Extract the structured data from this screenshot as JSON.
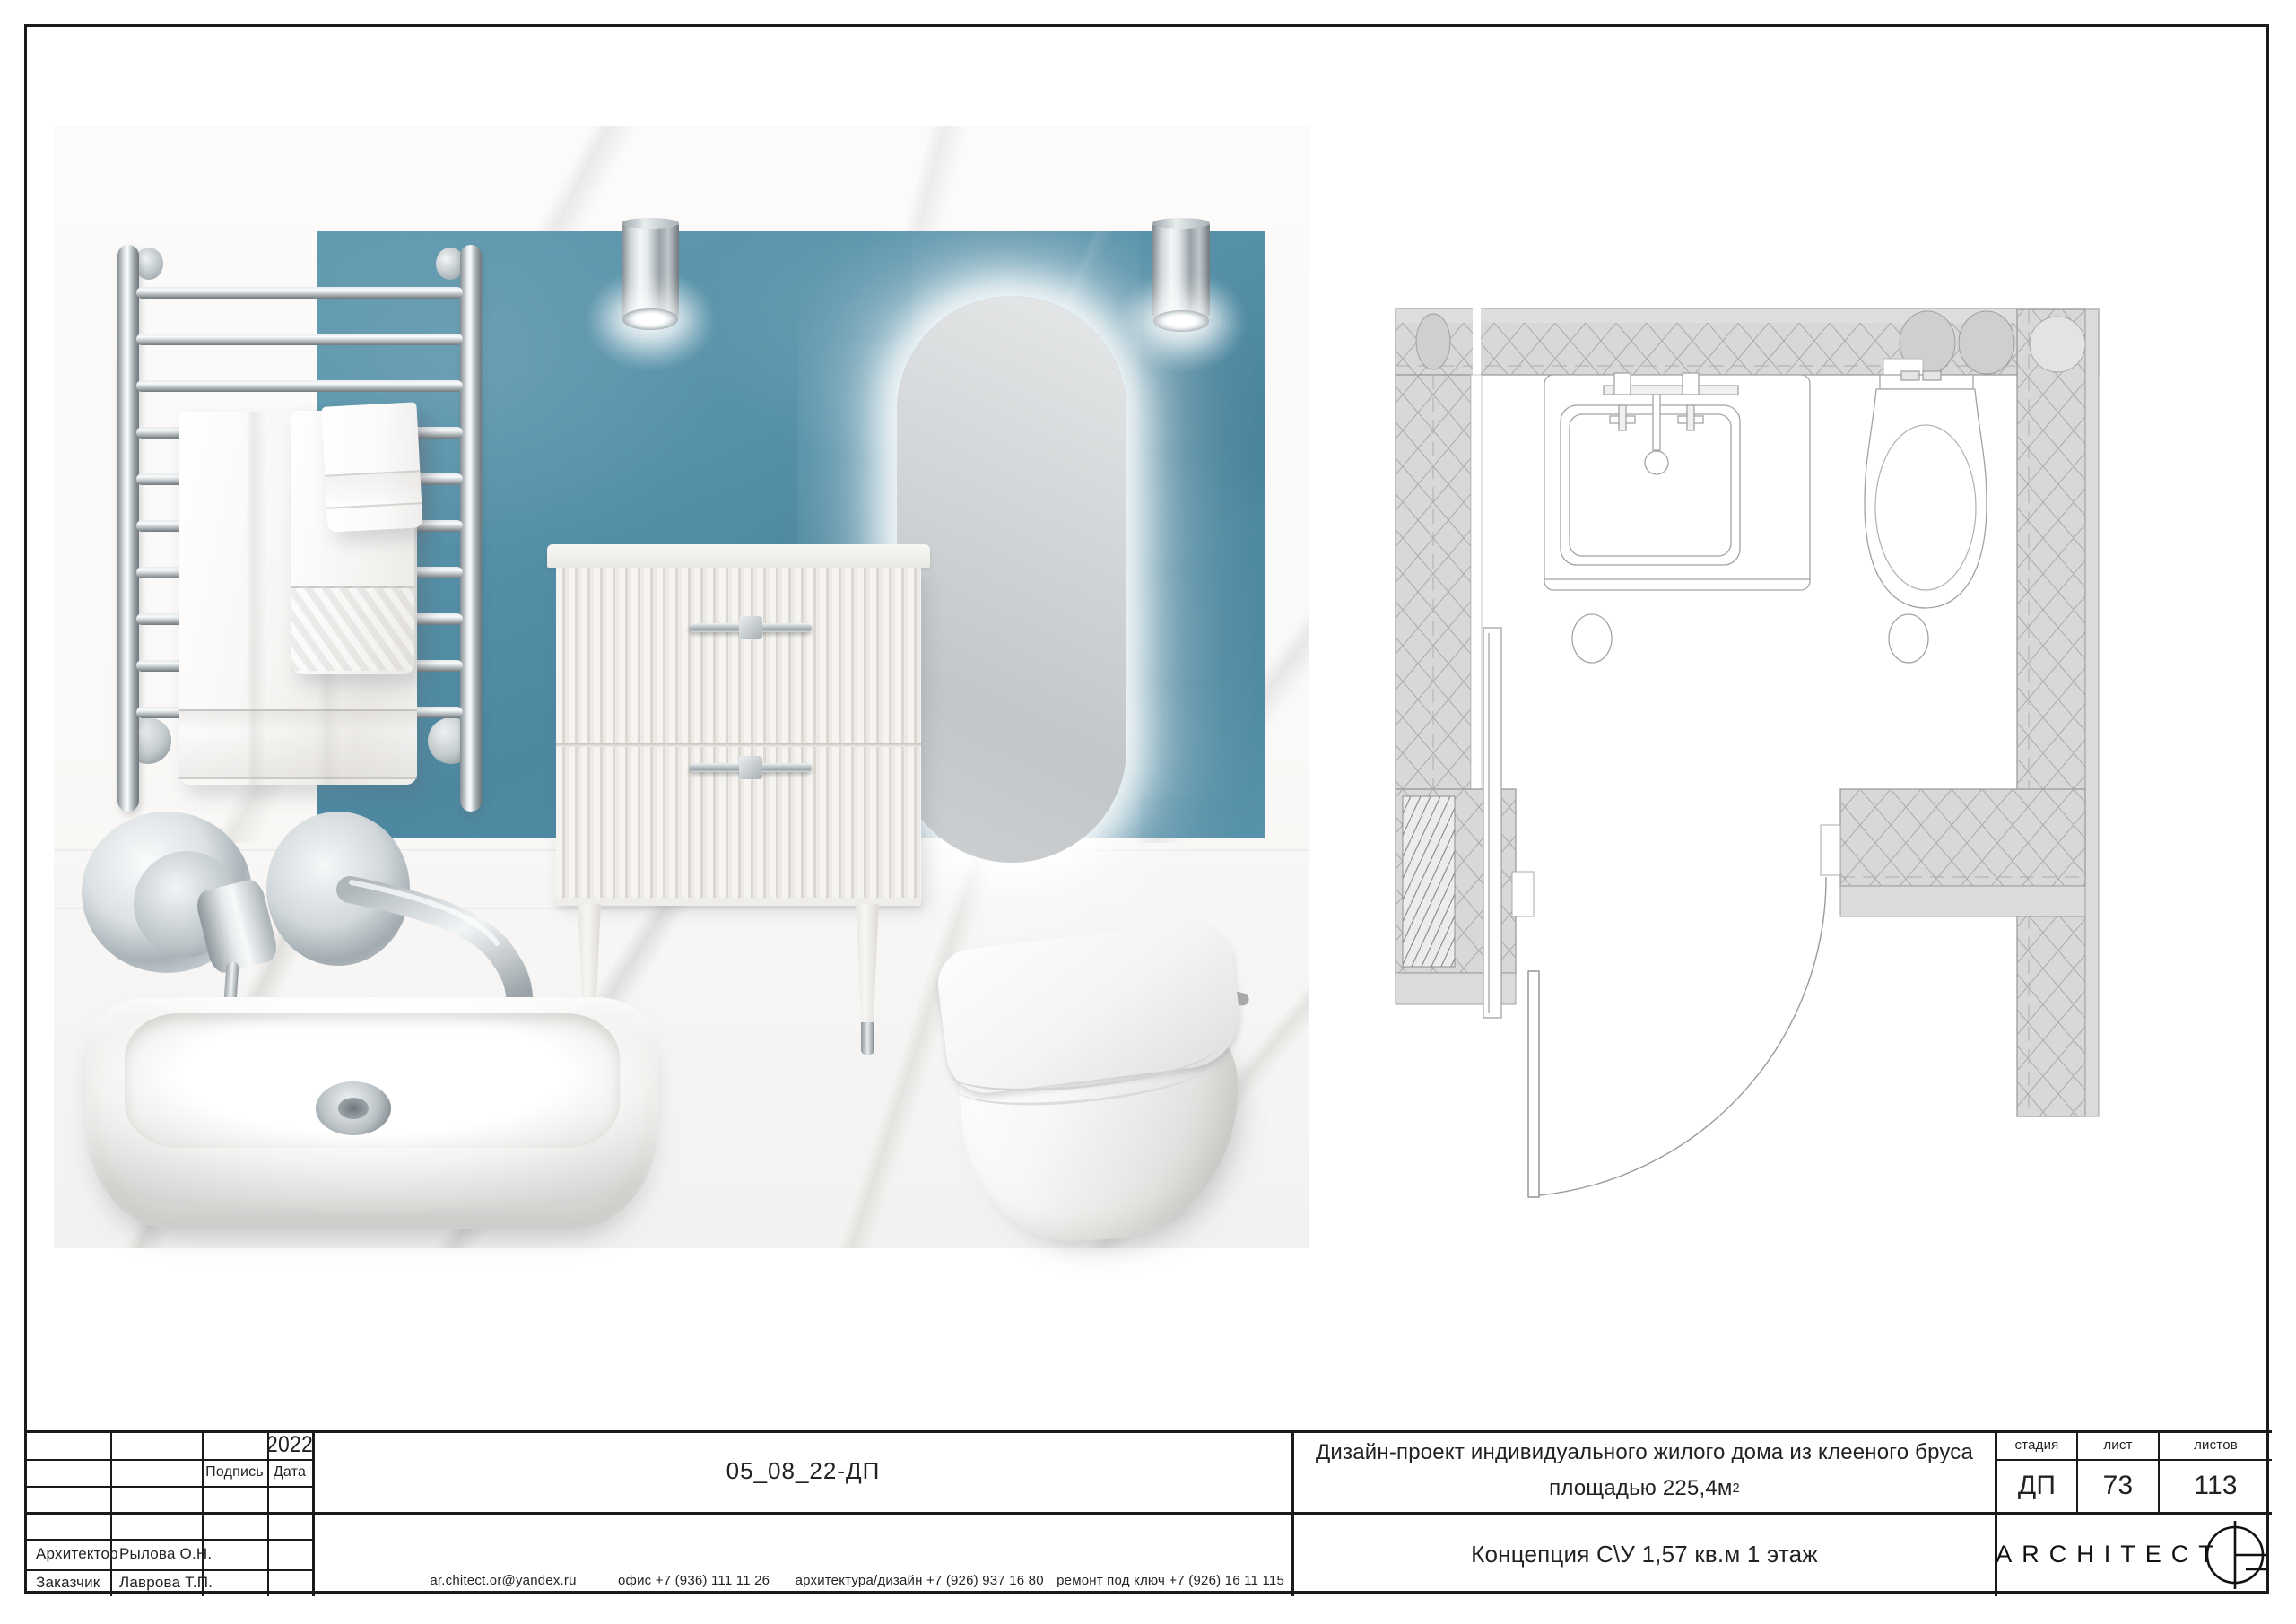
{
  "titleblock": {
    "year": "2022",
    "sign_label": "Подпись",
    "date_label": "Дата",
    "architect_label": "Архитектор",
    "architect_name": "Рылова О.Н.",
    "client_label": "Заказчик",
    "client_name": "Лаврова Т.П.",
    "doc_code": "05_08_22-ДП",
    "contact_email": "ar.chitect.or@yandex.ru",
    "contact_office": "офис +7 (936) 111 11 26",
    "contact_design": "архитектура/дизайн +7 (926) 937 16 80",
    "contact_turnkey": "ремонт под ключ +7 (926) 16 11 115",
    "project_title_line1": "Дизайн-проект индивидуального жилого дома из клееного бруса",
    "project_title_line2": "площадью 225,4м",
    "area_superscript": "2",
    "stage_label": "стадия",
    "sheet_label": "лист",
    "sheets_label": "листов",
    "stage_value": "ДП",
    "sheet_value": "73",
    "sheets_value": "113",
    "concept_caption": "Концепция С\\У 1,57 кв.м 1 этаж",
    "logo_text": "ARCHITECT"
  },
  "colors": {
    "accent_blue": "#5590a8",
    "marble": "#f5f4f2",
    "chrome": "#c9ced1",
    "plan_wall_gray": "#d8d8d8"
  }
}
